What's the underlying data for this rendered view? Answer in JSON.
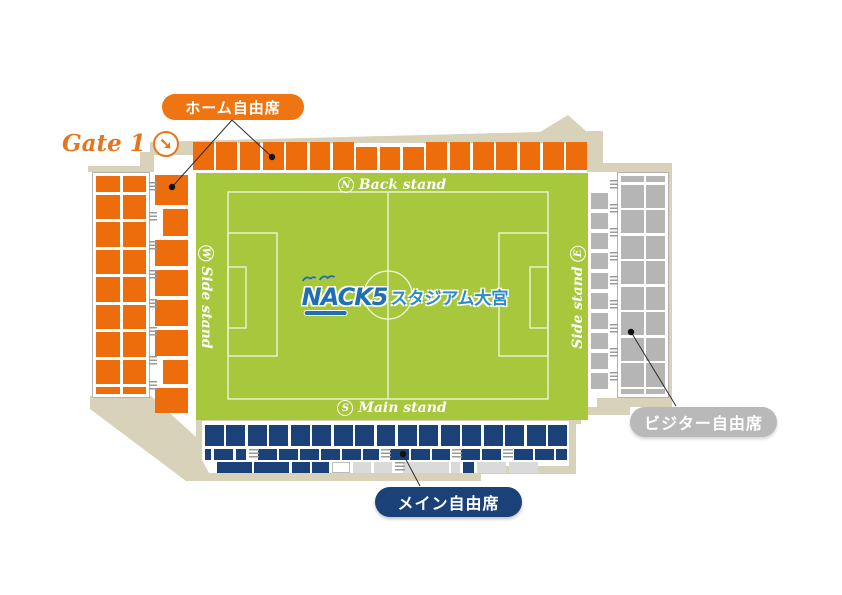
{
  "gate": {
    "label": "Gate 1",
    "icon": "arrow-down-right",
    "color": "#e5761e"
  },
  "legend": {
    "home": {
      "label": "ホーム自由席",
      "color": "#ed6d0d"
    },
    "visitor": {
      "label": "ビジター自由席",
      "color": "#b9b9b9"
    },
    "main": {
      "label": "メイン自由席",
      "color": "#1a4178"
    }
  },
  "pitch": {
    "color": "#a7c83d",
    "logo": {
      "brand": "NACK5",
      "name": "スタジアム大宮"
    },
    "stands": {
      "north": {
        "letter": "N",
        "label": "Back stand"
      },
      "south": {
        "letter": "S",
        "label": "Main stand"
      },
      "west": {
        "letter": "W",
        "label": "Side stand"
      },
      "east": {
        "letter": "E",
        "label": "Side stand"
      }
    }
  },
  "seating": {
    "north_blocks": 17,
    "north_short_range": [
      7,
      9
    ],
    "west_outer": {
      "cols": 2,
      "rows": 9
    },
    "east_outer": {
      "cols": 2,
      "rows": 10
    },
    "east_inner_blocks": 10,
    "south_row1_blocks": 17,
    "colors": {
      "home": "#ed6d0d",
      "visitor": "#b5b5b5",
      "main": "#1a4178",
      "unavailable": "#dadada",
      "pitch": "#a7c83d",
      "outline": "#d8d2bb",
      "home_pill": "#ef7512",
      "visitor_pill": "#b9b9b9",
      "gate": "#e5761e",
      "logo_navy": "#1e6fb4",
      "logo_blue": "#2b8ac9"
    }
  }
}
